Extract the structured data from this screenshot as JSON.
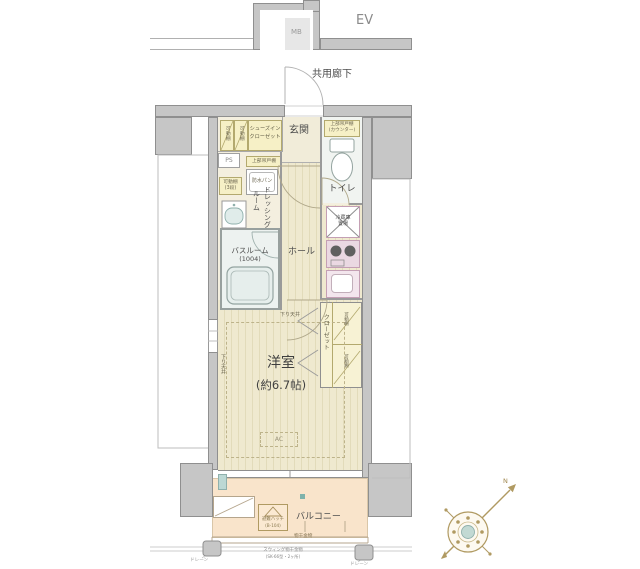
{
  "colors": {
    "wall_gray": "#c6c6c6",
    "wall_line": "#8f8f8f",
    "floor_cream": "#f4efdf",
    "flooring_stripe": "#e2dbba",
    "closet_yellow": "#f6f0c6",
    "kitchen_pink": "#ead8e2",
    "balcony_peach": "#f9e4cb",
    "bath_gray_green": "#edf2f0",
    "compass_tan": "#b09a62",
    "accent_teal": "#7fb2ab"
  },
  "top_area": {
    "ev": "EV",
    "mb": "MB",
    "corridor": "共用廊下"
  },
  "rooms": {
    "entrance": "玄関",
    "sic_line1": "シューズイン",
    "sic_line2": "クローゼット",
    "shelf_cell": "可動棚",
    "ps": "PS",
    "movable_shelf_line1": "可動棚",
    "movable_shelf_line2": "(3段)",
    "upper_cabinet": "上部吊戸棚",
    "waterproof_pan": "防水パン",
    "dressing_line1": "ドレッシング",
    "dressing_line2": "ルーム",
    "bathroom": "バスルーム",
    "bathroom_size": "(1004)",
    "toilet": "トイレ",
    "toilet_shelf_line1": "上部吊戸棚",
    "toilet_shelf_line2": "(カウンター)",
    "fridge_line1": "冷蔵庫",
    "fridge_line2": "置場",
    "hall": "ホール",
    "closet": "クローゼット",
    "closet_shelf": "可動棚",
    "room": "洋室",
    "room_size": "(約6.7帖)",
    "lowered_ceiling": "下り天井",
    "ac": "AC"
  },
  "balcony": {
    "label": "バルコニー",
    "hatch_line1": "避難ハッチ",
    "hatch_line2": "(B-104)",
    "laundry_bracket": "物干金物",
    "drain": "ドレーン",
    "note_line1": "スウィング物干金物",
    "note_line2": "(SK-66型・2ヶ所)"
  },
  "compass": {
    "north": "N"
  }
}
